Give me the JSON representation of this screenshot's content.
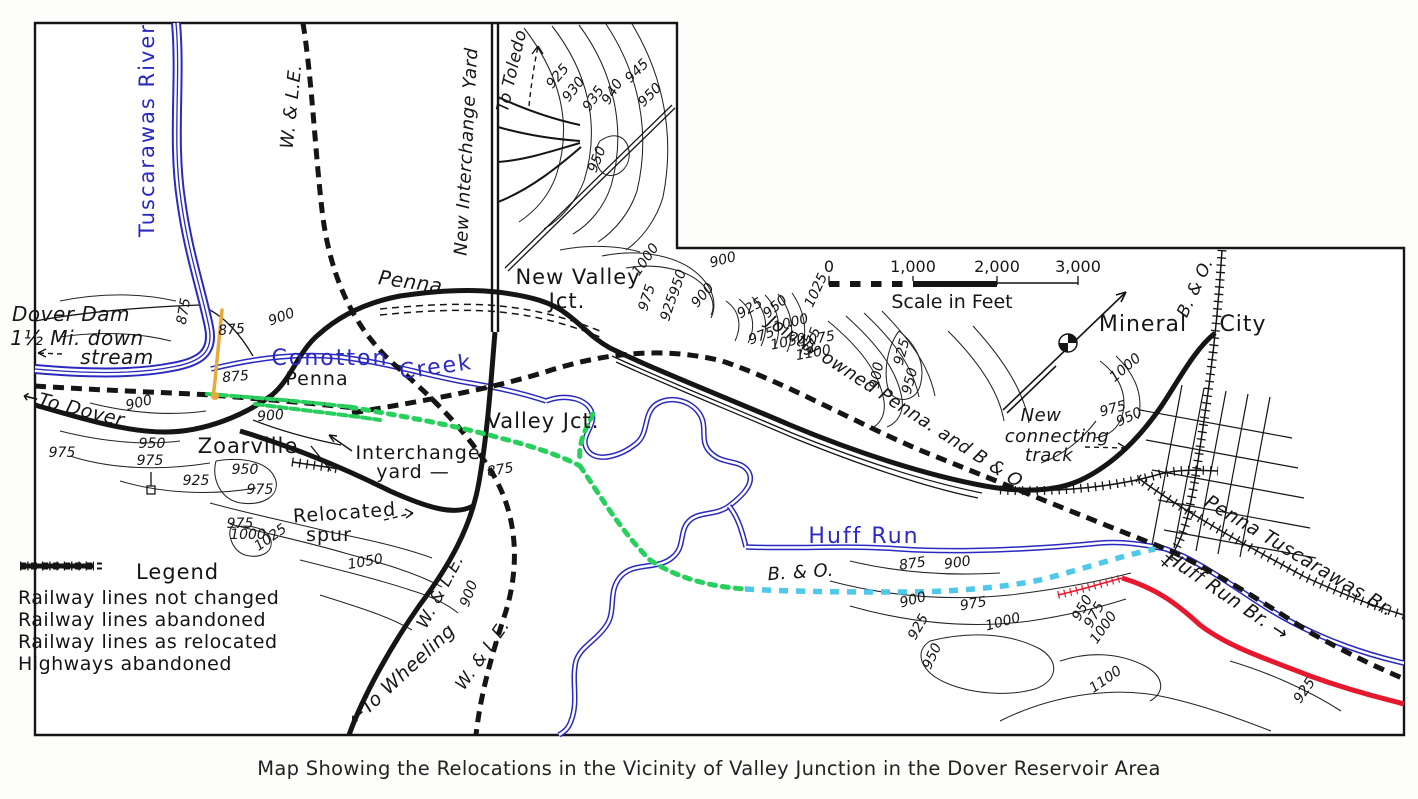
{
  "caption": "Map Showing the Relocations in the Vicinity of Valley Junction in the Dover Reservoir Area",
  "legend": {
    "title": "Legend",
    "items": [
      {
        "label": "Railway lines not changed",
        "style": "hatched"
      },
      {
        "label": "Railway lines abandoned",
        "style": "dashed"
      },
      {
        "label": "Railway lines as relocated",
        "style": "solid"
      },
      {
        "label": "Highways abandoned",
        "style": "double-dash"
      }
    ]
  },
  "scale_bar": {
    "tick_labels": [
      "0",
      "1,000",
      "2,000",
      "3,000"
    ],
    "label": "Scale in Feet"
  },
  "colors": {
    "water": "#2a2ac0",
    "relocated_green": "#27d05c",
    "relocated_cyan": "#4fc8ea",
    "relocated_red": "#e6182e",
    "crossing_orange": "#e8aa3c",
    "ink": "#151515"
  },
  "map_labels": [
    {
      "text": "Tuscarawas River",
      "x": 154,
      "y": 130,
      "rot": -90,
      "cls": "water",
      "size": 21
    },
    {
      "text": "W. & L.E.",
      "x": 297,
      "y": 107,
      "rot": -84,
      "cls": "rail",
      "size": 18
    },
    {
      "text": "New Interchange Yard",
      "x": 472,
      "y": 152,
      "rot": -87,
      "cls": "rail",
      "size": 18
    },
    {
      "text": "To Toledo",
      "x": 517,
      "y": 72,
      "rot": -77,
      "cls": "rail",
      "size": 17
    },
    {
      "text": "925",
      "x": 561,
      "y": 79,
      "rot": -50,
      "cls": "contour-lbl",
      "size": 14
    },
    {
      "text": "930",
      "x": 577,
      "y": 92,
      "rot": -52,
      "cls": "contour-lbl",
      "size": 14
    },
    {
      "text": "935",
      "x": 597,
      "y": 101,
      "rot": -55,
      "cls": "contour-lbl",
      "size": 14
    },
    {
      "text": "940",
      "x": 616,
      "y": 94,
      "rot": -58,
      "cls": "contour-lbl",
      "size": 14
    },
    {
      "text": "945",
      "x": 640,
      "y": 74,
      "rot": -45,
      "cls": "contour-lbl",
      "size": 14
    },
    {
      "text": "950",
      "x": 653,
      "y": 98,
      "rot": -45,
      "cls": "contour-lbl",
      "size": 14
    },
    {
      "text": "950",
      "x": 601,
      "y": 161,
      "rot": -68,
      "cls": "contour-lbl",
      "size": 14
    },
    {
      "text": "New Valley",
      "x": 578,
      "y": 284,
      "rot": 0,
      "cls": "place",
      "size": 21
    },
    {
      "text": "Jct.",
      "x": 567,
      "y": 308,
      "rot": 0,
      "cls": "place",
      "size": 21
    },
    {
      "text": "Penna.",
      "x": 413,
      "y": 289,
      "rot": 8,
      "cls": "rail",
      "size": 20
    },
    {
      "text": "1000",
      "x": 649,
      "y": 262,
      "rot": -55,
      "cls": "contour-lbl",
      "size": 14
    },
    {
      "text": "975",
      "x": 651,
      "y": 299,
      "rot": -72,
      "cls": "contour-lbl",
      "size": 14
    },
    {
      "text": "950",
      "x": 682,
      "y": 284,
      "rot": -72,
      "cls": "contour-lbl",
      "size": 14
    },
    {
      "text": "925",
      "x": 673,
      "y": 309,
      "rot": -72,
      "cls": "contour-lbl",
      "size": 14
    },
    {
      "text": "900",
      "x": 724,
      "y": 264,
      "rot": -15,
      "cls": "contour-lbl",
      "size": 14
    },
    {
      "text": "900",
      "x": 706,
      "y": 298,
      "rot": -50,
      "cls": "contour-lbl",
      "size": 14
    },
    {
      "text": "1025",
      "x": 820,
      "y": 292,
      "rot": -65,
      "cls": "contour-lbl",
      "size": 14
    },
    {
      "text": "875",
      "x": 816,
      "y": 342,
      "rot": -70,
      "cls": "contour-lbl",
      "size": 14
    },
    {
      "text": "925",
      "x": 752,
      "y": 312,
      "rot": -30,
      "cls": "contour-lbl",
      "size": 14
    },
    {
      "text": "950",
      "x": 778,
      "y": 310,
      "rot": -40,
      "cls": "contour-lbl",
      "size": 14
    },
    {
      "text": "975",
      "x": 763,
      "y": 340,
      "rot": -20,
      "cls": "contour-lbl",
      "size": 14
    },
    {
      "text": "1000",
      "x": 792,
      "y": 327,
      "rot": -15,
      "cls": "contour-lbl",
      "size": 14
    },
    {
      "text": "1050",
      "x": 789,
      "y": 346,
      "rot": -12,
      "cls": "contour-lbl",
      "size": 14
    },
    {
      "text": "1075",
      "x": 818,
      "y": 343,
      "rot": -10,
      "cls": "contour-lbl",
      "size": 14
    },
    {
      "text": "1100",
      "x": 814,
      "y": 357,
      "rot": -10,
      "cls": "contour-lbl",
      "size": 14
    },
    {
      "text": "900",
      "x": 881,
      "y": 376,
      "rot": -80,
      "cls": "contour-lbl",
      "size": 14
    },
    {
      "text": "925",
      "x": 906,
      "y": 353,
      "rot": -75,
      "cls": "contour-lbl",
      "size": 14
    },
    {
      "text": "950",
      "x": 914,
      "y": 382,
      "rot": -75,
      "cls": "contour-lbl",
      "size": 14
    },
    {
      "text": "Jointly owned Penna. and B & O.",
      "x": 894,
      "y": 408,
      "rot": 33,
      "cls": "rail",
      "size": 18
    },
    {
      "text": "Mineral",
      "x": 1143,
      "y": 331,
      "rot": 0,
      "cls": "place",
      "size": 22
    },
    {
      "text": "City",
      "x": 1243,
      "y": 331,
      "rot": 0,
      "cls": "place",
      "size": 22
    },
    {
      "text": "B. & O.",
      "x": 1200,
      "y": 290,
      "rot": -65,
      "cls": "rail",
      "size": 17
    },
    {
      "text": "New",
      "x": 1041,
      "y": 421,
      "rot": 0,
      "cls": "rail",
      "size": 18
    },
    {
      "text": "connecting",
      "x": 1057,
      "y": 442,
      "rot": 0,
      "cls": "rail",
      "size": 18
    },
    {
      "text": "track",
      "x": 1049,
      "y": 461,
      "rot": 0,
      "cls": "rail",
      "size": 18
    },
    {
      "text": "1000",
      "x": 1128,
      "y": 371,
      "rot": -40,
      "cls": "contour-lbl",
      "size": 14
    },
    {
      "text": "975",
      "x": 1114,
      "y": 413,
      "rot": -15,
      "cls": "contour-lbl",
      "size": 14
    },
    {
      "text": "950",
      "x": 1131,
      "y": 421,
      "rot": -25,
      "cls": "contour-lbl",
      "size": 14
    },
    {
      "text": "Dover Dam",
      "x": 71,
      "y": 321,
      "rot": 0,
      "cls": "rail",
      "size": 20
    },
    {
      "text": "1½ Mi. down",
      "x": 77,
      "y": 345,
      "rot": 0,
      "cls": "rail",
      "size": 20
    },
    {
      "text": "stream",
      "x": 117,
      "y": 364,
      "rot": 0,
      "cls": "rail",
      "size": 20
    },
    {
      "text": "←To Dover",
      "x": 72,
      "y": 414,
      "rot": 14,
      "cls": "rail",
      "size": 19
    },
    {
      "text": "875",
      "x": 188,
      "y": 312,
      "rot": -80,
      "cls": "contour-lbl",
      "size": 14
    },
    {
      "text": "875",
      "x": 232,
      "y": 334,
      "rot": -5,
      "cls": "contour-lbl",
      "size": 14
    },
    {
      "text": "875",
      "x": 236,
      "y": 381,
      "rot": -5,
      "cls": "contour-lbl",
      "size": 14
    },
    {
      "text": "900",
      "x": 283,
      "y": 321,
      "rot": -20,
      "cls": "contour-lbl",
      "size": 14
    },
    {
      "text": "900",
      "x": 140,
      "y": 407,
      "rot": -14,
      "cls": "contour-lbl",
      "size": 14
    },
    {
      "text": "900",
      "x": 271,
      "y": 420,
      "rot": -5,
      "cls": "contour-lbl",
      "size": 14
    },
    {
      "text": "975",
      "x": 62,
      "y": 457,
      "rot": 0,
      "cls": "contour-lbl",
      "size": 14
    },
    {
      "text": "950",
      "x": 152,
      "y": 448,
      "rot": 0,
      "cls": "contour-lbl",
      "size": 14
    },
    {
      "text": "975",
      "x": 150,
      "y": 465,
      "rot": 0,
      "cls": "contour-lbl",
      "size": 14
    },
    {
      "text": "Zoarville",
      "x": 248,
      "y": 453,
      "rot": 0,
      "cls": "place",
      "size": 21
    },
    {
      "text": "950",
      "x": 245,
      "y": 474,
      "rot": 0,
      "cls": "contour-lbl",
      "size": 14
    },
    {
      "text": "925",
      "x": 196,
      "y": 485,
      "rot": 0,
      "cls": "contour-lbl",
      "size": 14
    },
    {
      "text": "975",
      "x": 260,
      "y": 494,
      "rot": 0,
      "cls": "contour-lbl",
      "size": 14
    },
    {
      "text": "Conotton",
      "x": 330,
      "y": 365,
      "rot": 0,
      "cls": "water",
      "size": 22
    },
    {
      "text": "Creek",
      "x": 437,
      "y": 374,
      "rot": -8,
      "cls": "water",
      "size": 22
    },
    {
      "text": "Penna",
      "x": 317,
      "y": 385,
      "rot": 0,
      "cls": "place",
      "size": 19
    },
    {
      "text": "Valley Jct.",
      "x": 543,
      "y": 428,
      "rot": 0,
      "cls": "place",
      "size": 21
    },
    {
      "text": "Interchange",
      "x": 418,
      "y": 459,
      "rot": 0,
      "cls": "place",
      "size": 19
    },
    {
      "text": "yard —",
      "x": 413,
      "y": 478,
      "rot": 0,
      "cls": "place",
      "size": 19
    },
    {
      "text": "875",
      "x": 501,
      "y": 474,
      "rot": -10,
      "cls": "contour-lbl",
      "size": 14
    },
    {
      "text": "Relocated",
      "x": 345,
      "y": 519,
      "rot": -4,
      "cls": "place",
      "size": 19
    },
    {
      "text": "spur",
      "x": 329,
      "y": 541,
      "rot": 0,
      "cls": "place",
      "size": 19
    },
    {
      "text": "975",
      "x": 240,
      "y": 528,
      "rot": 0,
      "cls": "contour-lbl",
      "size": 14
    },
    {
      "text": "1000",
      "x": 248,
      "y": 539,
      "rot": 0,
      "cls": "contour-lbl",
      "size": 14
    },
    {
      "text": "1025",
      "x": 273,
      "y": 541,
      "rot": -35,
      "cls": "contour-lbl",
      "size": 14
    },
    {
      "text": "1050",
      "x": 366,
      "y": 566,
      "rot": -10,
      "cls": "contour-lbl",
      "size": 14
    },
    {
      "text": "W. & L.E.",
      "x": 445,
      "y": 594,
      "rot": -62,
      "cls": "rail",
      "size": 17
    },
    {
      "text": "900",
      "x": 473,
      "y": 595,
      "rot": -70,
      "cls": "contour-lbl",
      "size": 14
    },
    {
      "text": "W. & L.E.",
      "x": 487,
      "y": 658,
      "rot": -55,
      "cls": "rail",
      "size": 17
    },
    {
      "text": "←To Wheeling",
      "x": 406,
      "y": 679,
      "rot": -43,
      "cls": "rail",
      "size": 19
    },
    {
      "text": "Huff Run",
      "x": 864,
      "y": 543,
      "rot": 0,
      "cls": "water",
      "size": 22
    },
    {
      "text": "B. & O.",
      "x": 801,
      "y": 578,
      "rot": -4,
      "cls": "rail",
      "size": 18
    },
    {
      "text": "875",
      "x": 913,
      "y": 568,
      "rot": -8,
      "cls": "contour-lbl",
      "size": 14
    },
    {
      "text": "900",
      "x": 958,
      "y": 567,
      "rot": -8,
      "cls": "contour-lbl",
      "size": 14
    },
    {
      "text": "900",
      "x": 914,
      "y": 604,
      "rot": -15,
      "cls": "contour-lbl",
      "size": 14
    },
    {
      "text": "925",
      "x": 922,
      "y": 629,
      "rot": -60,
      "cls": "contour-lbl",
      "size": 14
    },
    {
      "text": "950",
      "x": 936,
      "y": 658,
      "rot": -65,
      "cls": "contour-lbl",
      "size": 14
    },
    {
      "text": "975",
      "x": 974,
      "y": 608,
      "rot": -10,
      "cls": "contour-lbl",
      "size": 14
    },
    {
      "text": "1000",
      "x": 1004,
      "y": 626,
      "rot": -15,
      "cls": "contour-lbl",
      "size": 14
    },
    {
      "text": "950",
      "x": 1086,
      "y": 610,
      "rot": -60,
      "cls": "contour-lbl",
      "size": 14
    },
    {
      "text": "975",
      "x": 1098,
      "y": 617,
      "rot": -60,
      "cls": "contour-lbl",
      "size": 14
    },
    {
      "text": "1000",
      "x": 1107,
      "y": 630,
      "rot": -55,
      "cls": "contour-lbl",
      "size": 14
    },
    {
      "text": "1100",
      "x": 1108,
      "y": 683,
      "rot": -35,
      "cls": "contour-lbl",
      "size": 14
    },
    {
      "text": "925",
      "x": 1308,
      "y": 693,
      "rot": -55,
      "cls": "contour-lbl",
      "size": 14
    },
    {
      "text": "Huff Run Br. →",
      "x": 1224,
      "y": 601,
      "rot": 34,
      "cls": "rail",
      "size": 19
    },
    {
      "text": "Penna Tuscarawas Br.",
      "x": 1296,
      "y": 561,
      "rot": 31,
      "cls": "rail",
      "size": 19
    }
  ]
}
